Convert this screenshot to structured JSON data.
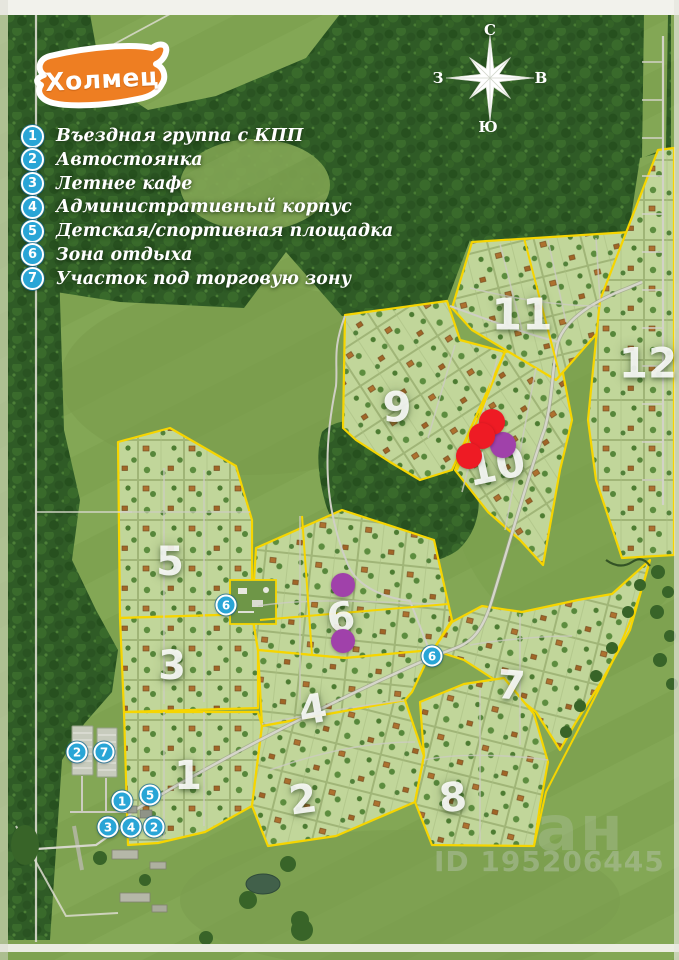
{
  "title": {
    "banner_label": "Холмец"
  },
  "legend": {
    "items": [
      {
        "num": "1",
        "label": "Въездная группа с КПП"
      },
      {
        "num": "2",
        "label": "Автостоянка"
      },
      {
        "num": "3",
        "label": "Летнее кафе"
      },
      {
        "num": "4",
        "label": "Административный корпус"
      },
      {
        "num": "5",
        "label": "Детская/спортивная площадка"
      },
      {
        "num": "6",
        "label": "Зона отдыха"
      },
      {
        "num": "7",
        "label": "Участок под торговую зону"
      }
    ]
  },
  "compass": {
    "north": "С",
    "south": "Ю",
    "west": "З",
    "east": "В"
  },
  "map": {
    "section_labels": [
      {
        "text": "1",
        "x": 188,
        "y": 776,
        "size": 40,
        "rot": 0
      },
      {
        "text": "2",
        "x": 303,
        "y": 800,
        "size": 40,
        "rot": -8
      },
      {
        "text": "3",
        "x": 172,
        "y": 666,
        "size": 40,
        "rot": 0
      },
      {
        "text": "4",
        "x": 313,
        "y": 710,
        "size": 40,
        "rot": -10
      },
      {
        "text": "5",
        "x": 170,
        "y": 562,
        "size": 40,
        "rot": 0
      },
      {
        "text": "6",
        "x": 341,
        "y": 618,
        "size": 40,
        "rot": -10
      },
      {
        "text": "7",
        "x": 511,
        "y": 686,
        "size": 40,
        "rot": 5
      },
      {
        "text": "8",
        "x": 453,
        "y": 798,
        "size": 40,
        "rot": -5
      },
      {
        "text": "9",
        "x": 397,
        "y": 407,
        "size": 42,
        "rot": 0
      },
      {
        "text": "10",
        "x": 496,
        "y": 466,
        "size": 42,
        "rot": -12
      },
      {
        "text": "11",
        "x": 522,
        "y": 315,
        "size": 44,
        "rot": 0
      },
      {
        "text": "12",
        "x": 648,
        "y": 363,
        "size": 42,
        "rot": 0
      }
    ],
    "badges": [
      {
        "label": "2",
        "x": 77,
        "y": 752
      },
      {
        "label": "7",
        "x": 104,
        "y": 752
      },
      {
        "label": "1",
        "x": 122,
        "y": 801
      },
      {
        "label": "5",
        "x": 150,
        "y": 795
      },
      {
        "label": "3",
        "x": 108,
        "y": 827
      },
      {
        "label": "4",
        "x": 131,
        "y": 827
      },
      {
        "label": "2",
        "x": 154,
        "y": 827
      },
      {
        "label": "6",
        "x": 226,
        "y": 605
      },
      {
        "label": "6",
        "x": 432,
        "y": 656
      }
    ],
    "markers": [
      {
        "color": "purple",
        "x": 503,
        "y": 445,
        "r": 13
      },
      {
        "color": "red",
        "x": 492,
        "y": 422,
        "r": 13
      },
      {
        "color": "red",
        "x": 482,
        "y": 436,
        "r": 13
      },
      {
        "color": "red",
        "x": 469,
        "y": 456,
        "r": 13
      },
      {
        "color": "purple",
        "x": 343,
        "y": 585,
        "r": 12
      },
      {
        "color": "purple",
        "x": 343,
        "y": 641,
        "r": 12
      }
    ]
  },
  "watermark": {
    "logo_fragment": "ан",
    "id_text": "ID 195206445"
  },
  "colors": {
    "banner_orange": "#ee7e22",
    "badge_blue": "#29a5d6",
    "boundary_yellow": "#f6d500",
    "marker_red": "#ee1b24",
    "marker_purple": "#a041aa",
    "field_green": "#7d9f50",
    "forest_green": "#2f5b26",
    "plot_green": "#c1d69a"
  }
}
